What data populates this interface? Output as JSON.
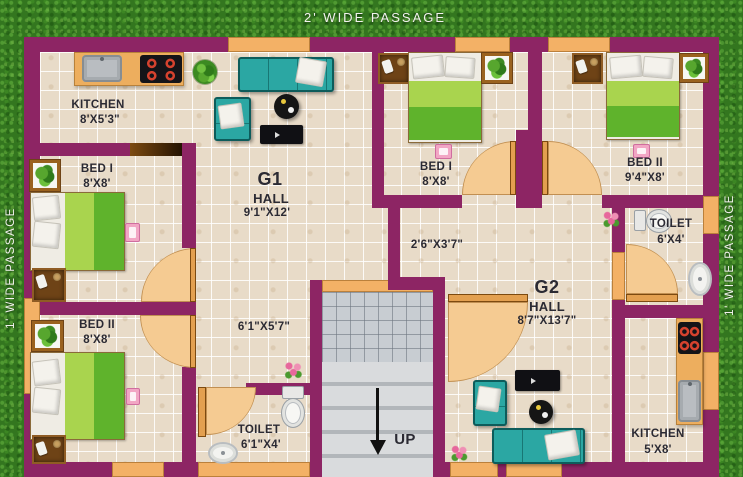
{
  "passages": {
    "top": "2'  WIDE PASSAGE",
    "left": "1' WIDE PASSAGE",
    "right": "1' WIDE PASSAGE"
  },
  "stairs": {
    "direction_label": "UP"
  },
  "g1": {
    "kitchen_name": "KITCHEN",
    "kitchen_dims": "8'X5'3\"",
    "bed1_name": "BED I",
    "bed1_dims": "8'X8'",
    "bed2_name": "BED II",
    "bed2_dims": "8'X8'",
    "unit_label": "G1",
    "hall_name": "HALL",
    "hall_dims": "9'1\"X12'",
    "corridor_dims": "6'1\"X5'7\"",
    "toilet_name": "TOILET",
    "toilet_dims": "6'1\"X4'"
  },
  "g2": {
    "bed1_name": "BED I",
    "bed1_dims": "8'X8'",
    "bed2_name": "BED II",
    "bed2_dims": "9'4\"X8'",
    "toilet_name": "TOILET",
    "toilet_dims": "6'X4'",
    "corridor_dims": "2'6\"X3'7\"",
    "unit_label": "G2",
    "hall_name": "HALL",
    "hall_dims": "8'7\"X13'7\"",
    "kitchen_name": "KITCHEN",
    "kitchen_dims": "5'X8'"
  },
  "colors": {
    "wall": "#8d2564",
    "window": "#f3b166",
    "floor": "#e8dbc8",
    "grass": "#33761f",
    "door_arc": "#f5cb92",
    "sofa": "#2ba7a3",
    "bed_light": "#a9d44e",
    "bed_dark": "#5fb32c",
    "stairs": "#d0d3d6",
    "label_text": "#2b2a33",
    "passage_text": "#f2f2ee"
  }
}
